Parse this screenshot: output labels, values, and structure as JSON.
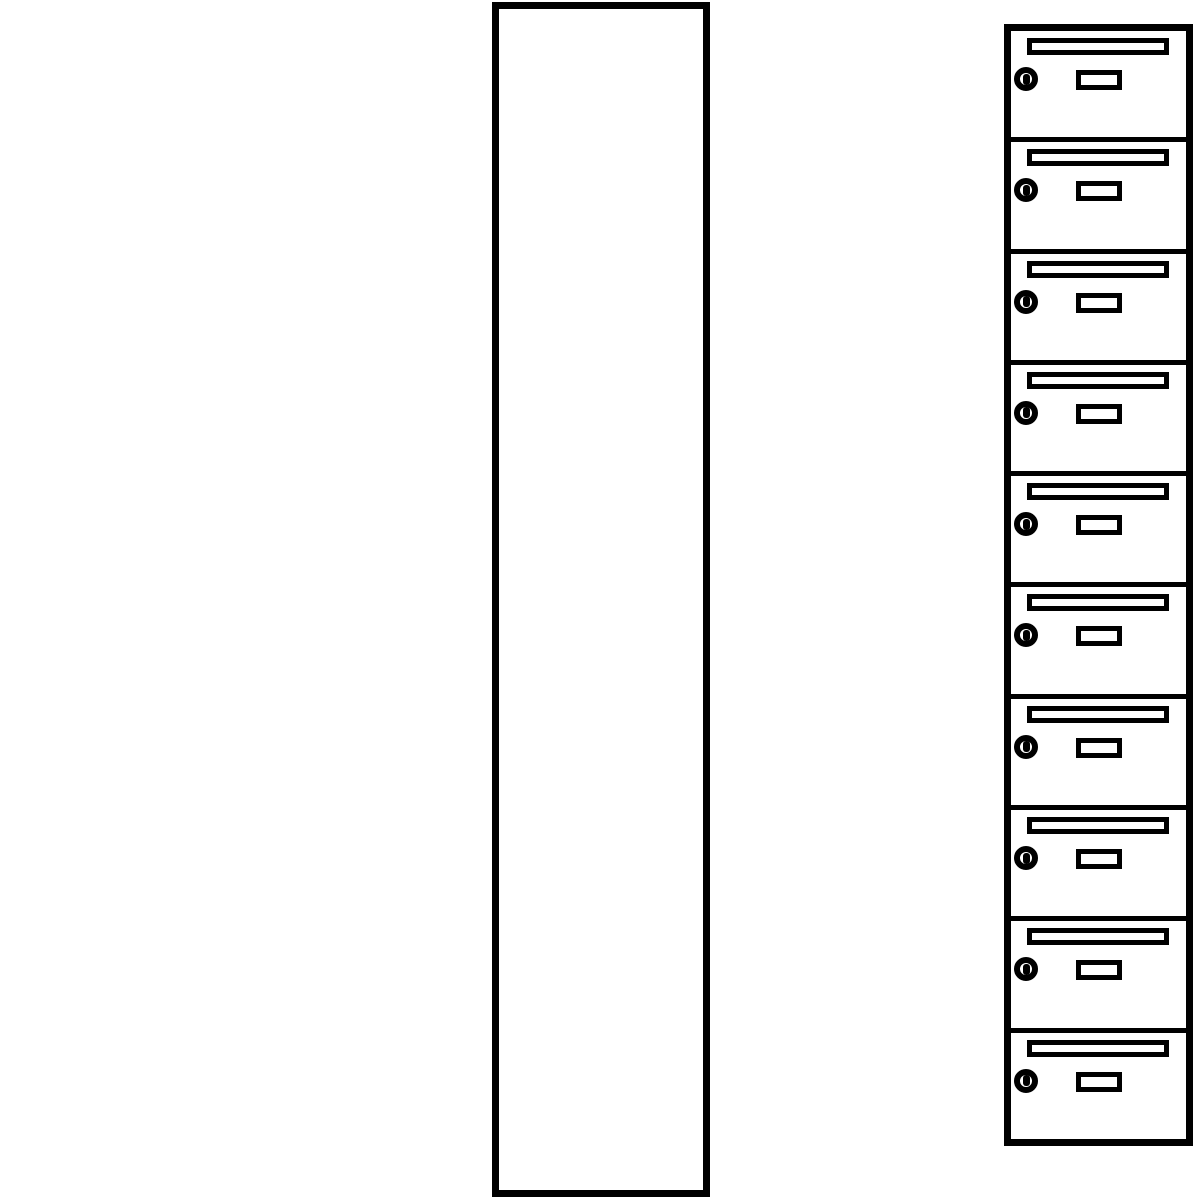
{
  "figure": {
    "type": "line-drawing",
    "subject": "vertical mailbox locker column with ten compartments",
    "line_color": "#000000",
    "background_color": "#ffffff",
    "compartment_count": 10,
    "compartment_features": [
      "mail-slot",
      "cylinder-lock",
      "label-holder"
    ]
  },
  "compartments": [
    {
      "index": 1
    },
    {
      "index": 2
    },
    {
      "index": 3
    },
    {
      "index": 4
    },
    {
      "index": 5
    },
    {
      "index": 6
    },
    {
      "index": 7
    },
    {
      "index": 8
    },
    {
      "index": 9
    },
    {
      "index": 10
    }
  ]
}
